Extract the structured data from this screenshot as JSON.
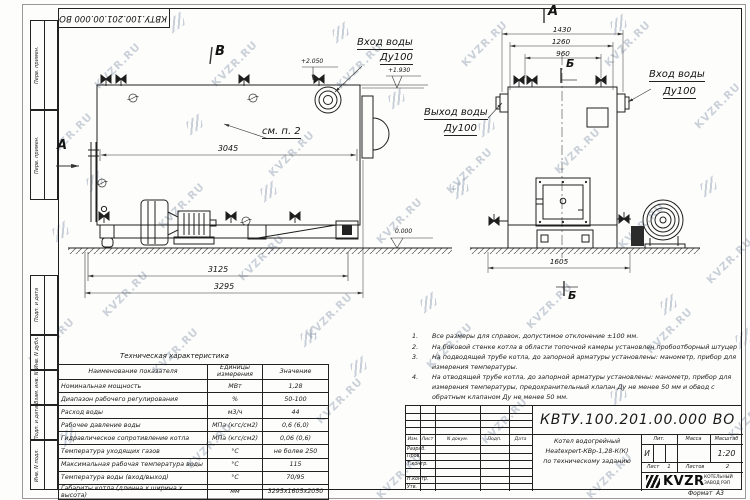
{
  "sheet": {
    "stamp": "КВТУ.100.201.00.000 ВО",
    "format_label": "Формат",
    "format_value": "А3",
    "watermark": "KVZR.RU"
  },
  "side_strip": {
    "labels": [
      "Перв. примен.",
      "Перв. примен.",
      "Подп. и дата",
      "Инв. N дубл.",
      "Взам. инв. N",
      "Подп. и дата",
      "Инв. N подл."
    ]
  },
  "left_view": {
    "view_label": "В",
    "section_arrow_label": "А",
    "callout": "см. п. 2",
    "inlet_label": "Вход воды",
    "inlet_dn": "Ду100",
    "elev_top": "+2.050",
    "elev_mid": "+1.930",
    "elev_zero": "0.000",
    "dim_body": "3045",
    "dim_frame": "3125",
    "dim_overall": "3295"
  },
  "front_view": {
    "view_label": "А",
    "section_top": "Б",
    "section_bottom": "Б",
    "outlet_label": "Выход воды",
    "outlet_dn": "Ду100",
    "inlet_label": "Вход воды",
    "inlet_dn": "Ду100",
    "dim_overall": "1430",
    "dim_body": "1260",
    "dim_valves": "960",
    "dim_base": "1605"
  },
  "notes": [
    {
      "num": "1.",
      "text": "Все размеры для справок, допустимое отклонение ±100 мм."
    },
    {
      "num": "2.",
      "text": "На боковой стенке котла в области топочной камеры установлен пробоотборный штуцер"
    },
    {
      "num": "3.",
      "text": "На подводящей трубе котла, до запорной арматуры установлены: манометр, прибор для измерения температуры."
    },
    {
      "num": "4.",
      "text": "На отводящей трубе котла, до запорной арматуры установлены: манометр, прибор для измерения температуры, предохранительный клапан Ду не менее 50 мм и обвод с обратным клапаном Ду не менее 50 мм."
    }
  ],
  "spec_table": {
    "title": "Техническая характеристика",
    "headers": [
      "Наименование показателя",
      "Единицы измерения",
      "Значение"
    ],
    "rows": [
      [
        "Номинальная мощность",
        "МВт",
        "1,28"
      ],
      [
        "Диапазон рабочего регулирования",
        "%",
        "50-100"
      ],
      [
        "Расход воды",
        "м3/ч",
        "44"
      ],
      [
        "Рабочее давление воды",
        "МПа (кгс/см2)",
        "0,6 (6,0)"
      ],
      [
        "Гидравлическое сопротивление котла",
        "МПа (кгс/см2)",
        "0,06 (0,6)"
      ],
      [
        "Температура уходящих газов",
        "°С",
        "не более 250"
      ],
      [
        "Максимальная рабочая температура воды",
        "°С",
        "115"
      ],
      [
        "Температура воды (вход/выход)",
        "°С",
        "70/95"
      ],
      [
        "Габариты котла (длинна х ширина х высота)",
        "мм",
        "3295х1605х2050"
      ]
    ]
  },
  "title_block": {
    "doc_number": "КВТУ.100.201.00.000 ВО",
    "header_cells": [
      "Изм.",
      "Лист",
      "N докум.",
      "Подп.",
      "Дата"
    ],
    "row_labels": [
      "Разраб.",
      "Пров.",
      "Т.контр.",
      "Н.контр.",
      "Утв."
    ],
    "description_lines": [
      "Котел водогрейный",
      "Heatexpert-КВр-1,28-К(К)",
      "по техническому заданию"
    ],
    "lit_header": "Лит.",
    "mass_header": "Масса",
    "scale_header": "Масштаб",
    "lit_value": "И",
    "scale_value": "1:20",
    "sheet_label": "Лист",
    "sheet_value": "1",
    "sheets_label": "Листов",
    "sheets_value": "2",
    "logo_text": "KVZR",
    "company_line1": "КОТЕЛЬНЫЙ",
    "company_line2": "ЗАВОД РЭП"
  }
}
